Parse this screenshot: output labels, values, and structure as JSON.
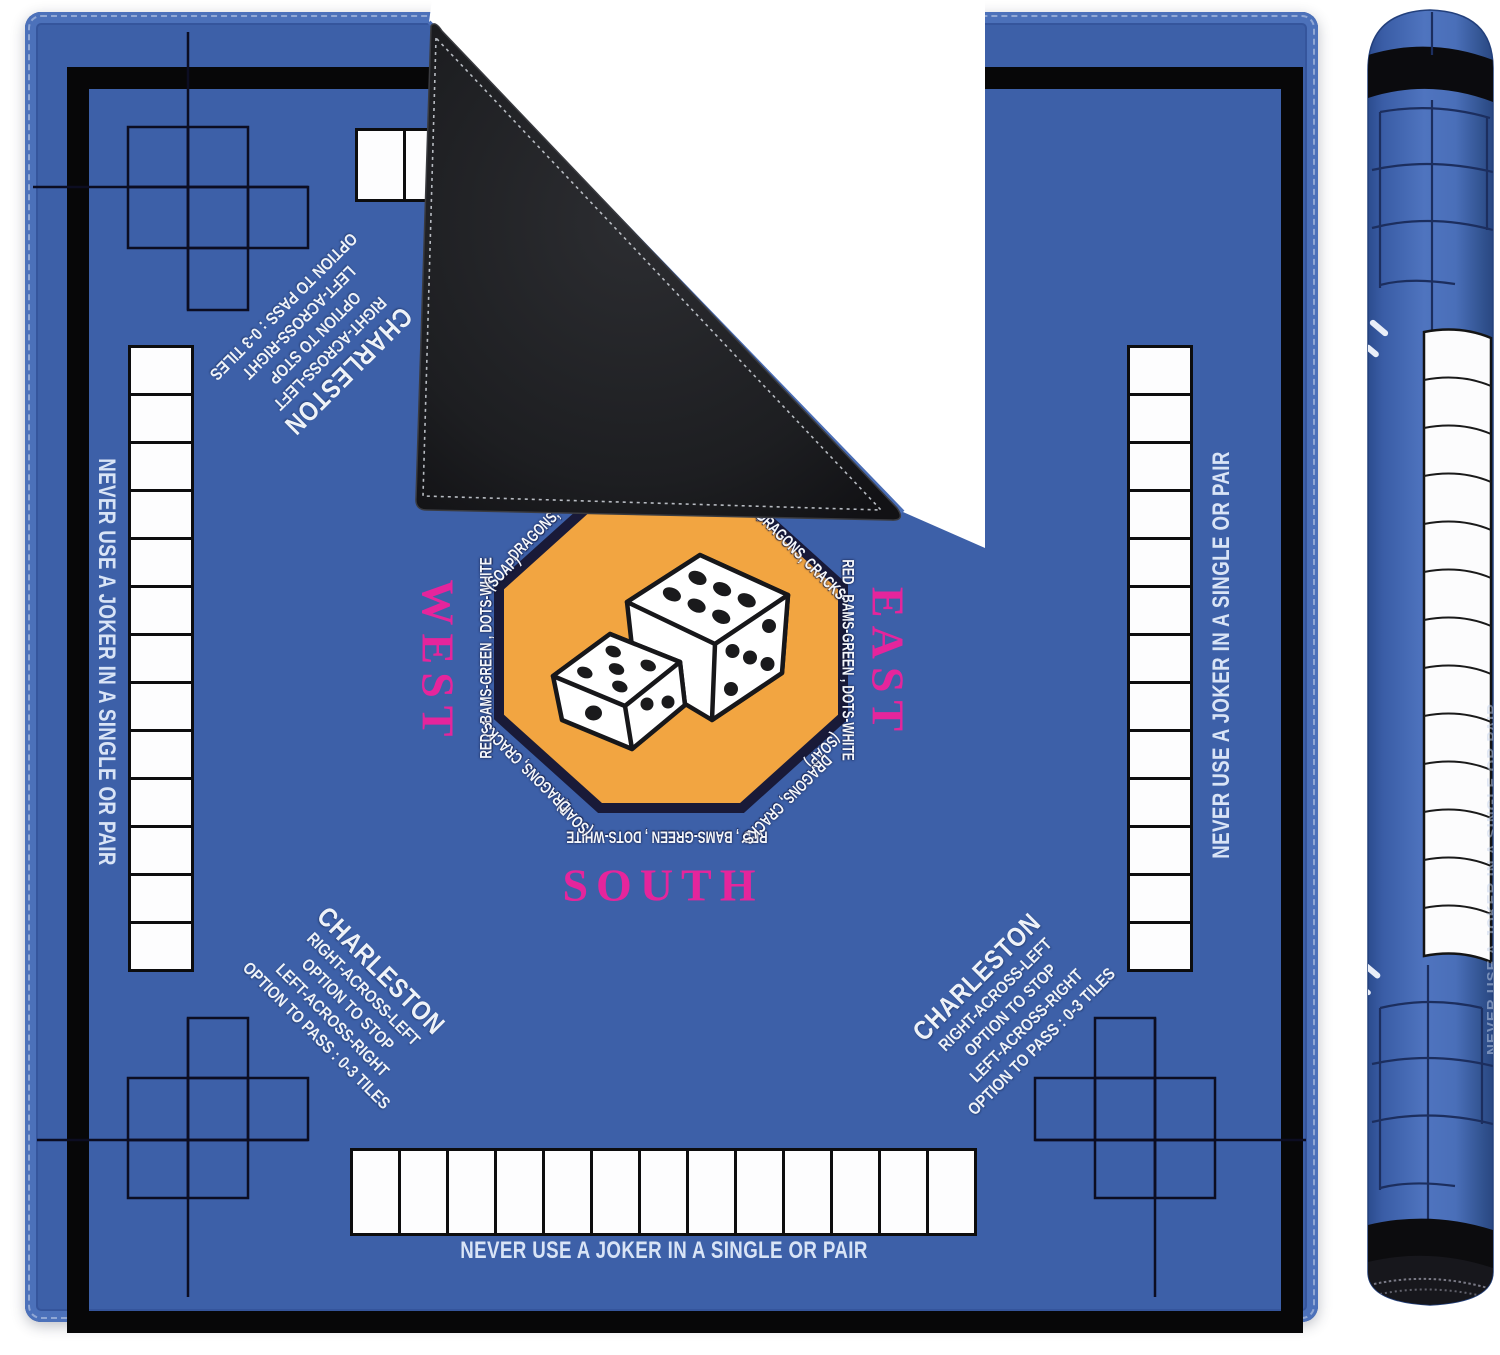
{
  "mat": {
    "edge_warning": "NEVER USE A JOKER IN A SINGLE OR PAIR",
    "directions": {
      "north": "NORTH",
      "east": "EAST",
      "south": "SOUTH",
      "west": "WEST"
    },
    "octagon": {
      "suits_line": "RED , BAMS-GREEN , DOTS-WHITE",
      "dragons_line": "DRAGONS, CRACKS-",
      "soap_line": "(SOAP)"
    },
    "charleston": {
      "title": "CHARLESTON",
      "line1": "RIGHT-ACROSS-LEFT",
      "line2": "OPTION TO STOP",
      "line3": "LEFT-ACROSS-RIGHT",
      "line4": "OPTION TO PASS :  0-3 TILES"
    },
    "rack_tile_count": 13,
    "colors": {
      "mat_blue": "#3d60a8",
      "edge_stitch_blue": "#4c71ba",
      "frame_black": "#070708",
      "octagon_fill": "#f2a541",
      "octagon_border": "#191a38",
      "direction_pink": "#e5259c",
      "warning_text": "#d9e4f6",
      "tile_white": "#fdfdfe",
      "backing_black": "#1d1e21"
    }
  },
  "roll": {
    "edge_warning": "NEVER USE A JOKER IN A SINGLE OR PAIR"
  }
}
